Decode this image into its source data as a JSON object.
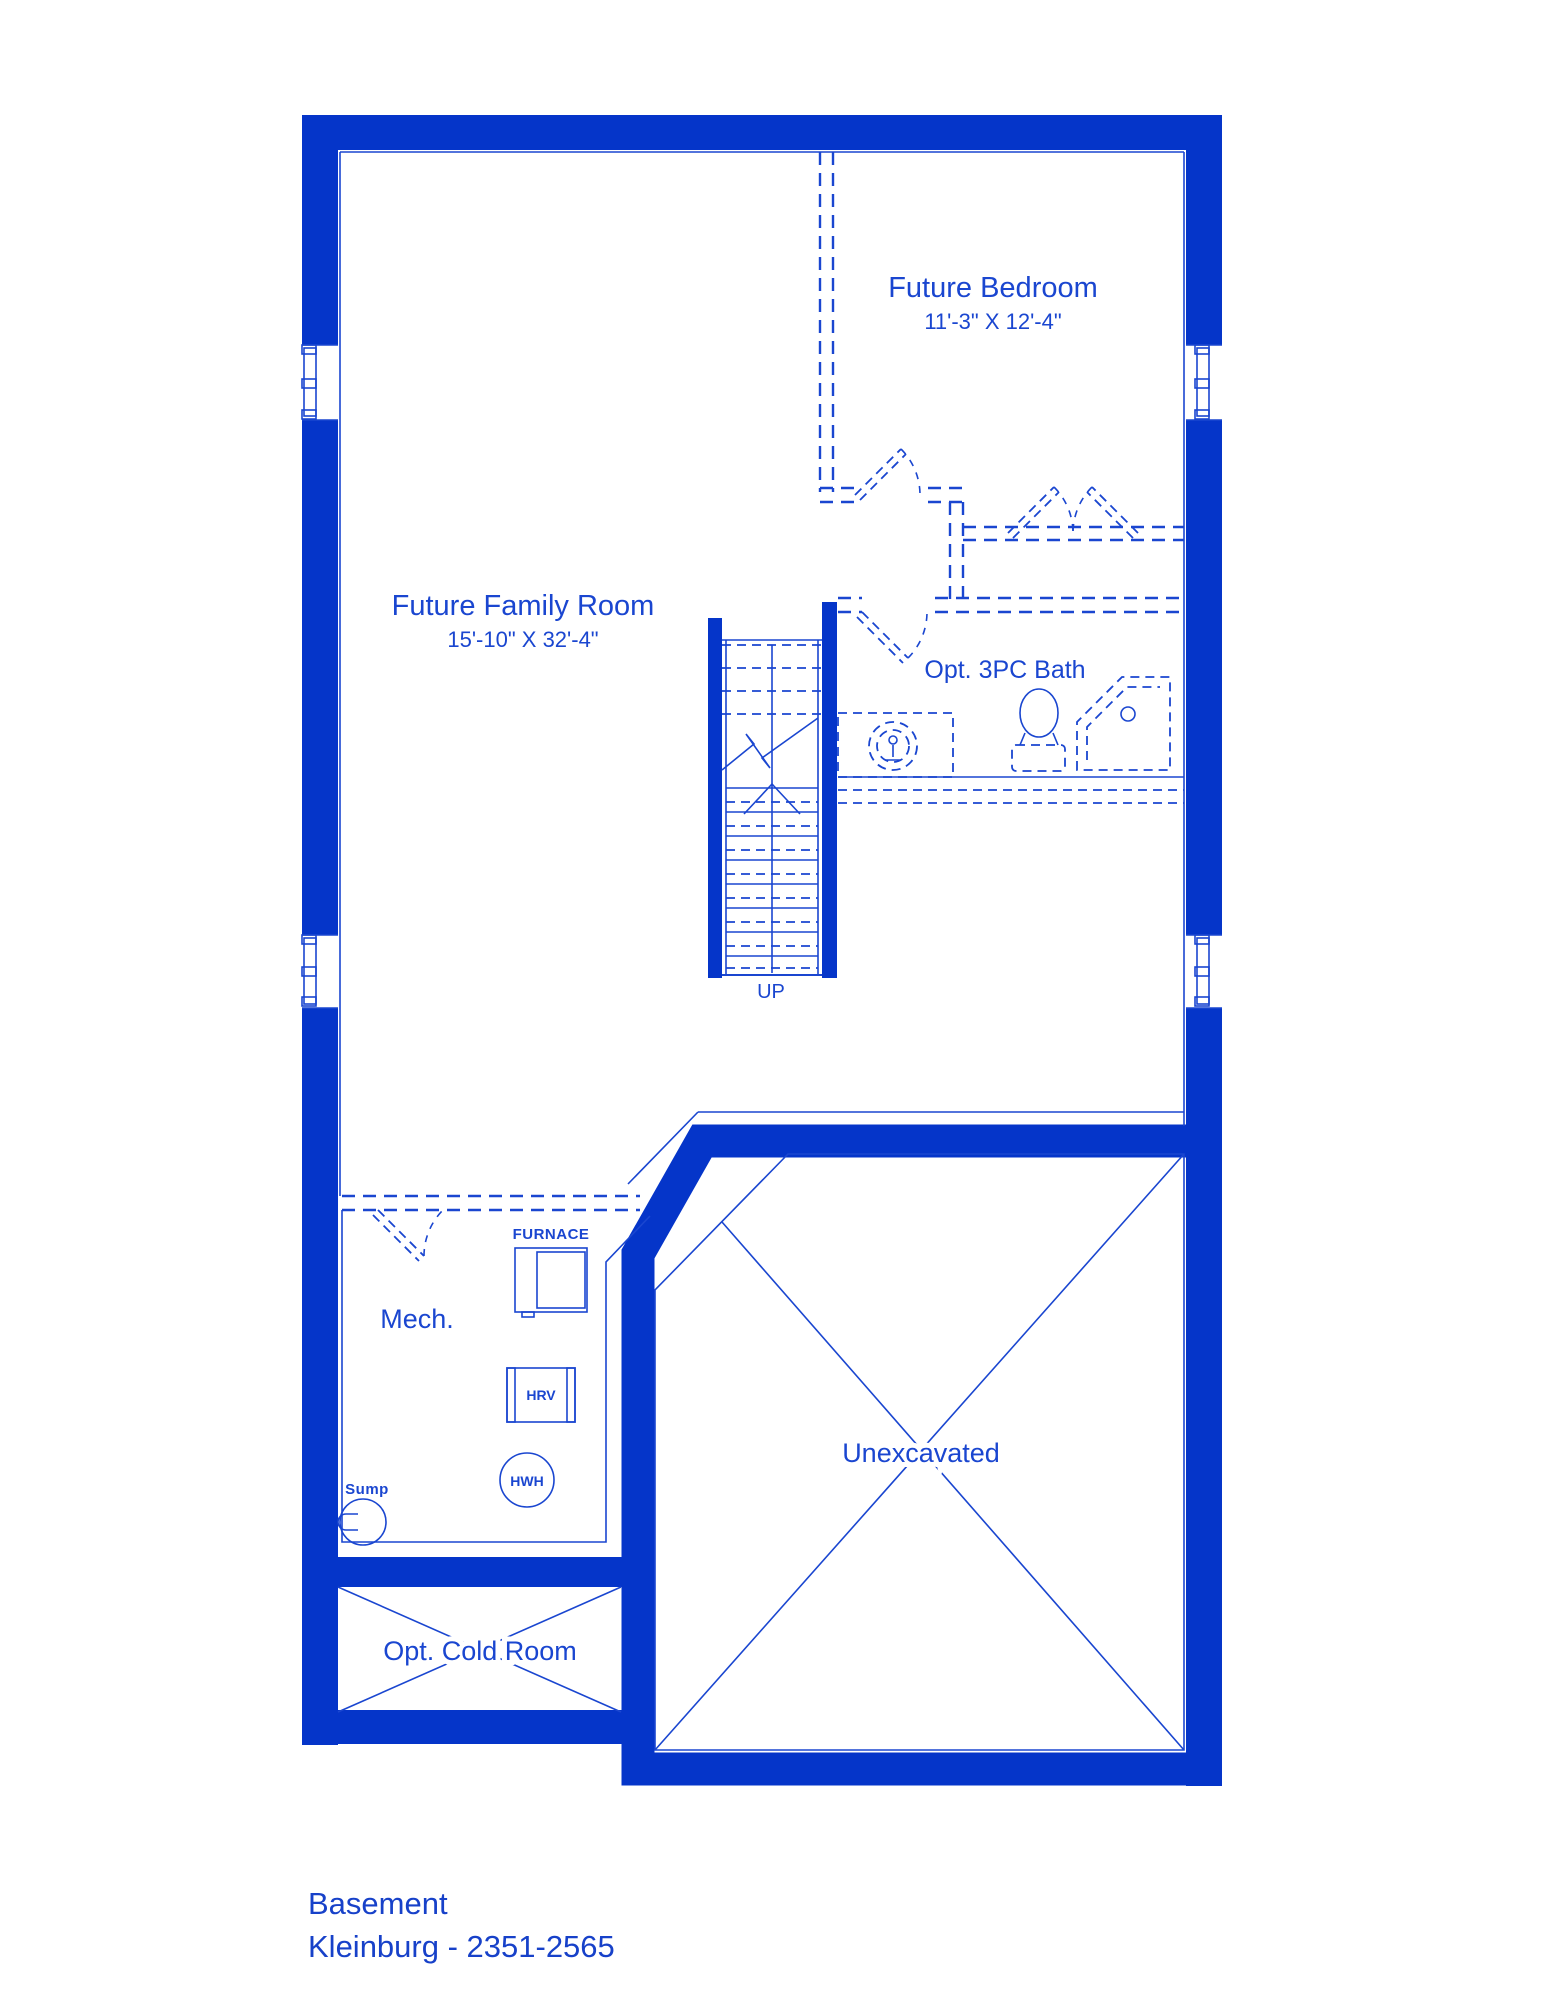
{
  "plan": {
    "rooms": {
      "future_bedroom": {
        "label": "Future Bedroom",
        "dimensions": "11'-3\" X 12'-4\""
      },
      "future_family_room": {
        "label": "Future Family Room",
        "dimensions": "15'-10\" X 32'-4\""
      },
      "opt_bath": {
        "label": "Opt. 3PC Bath"
      },
      "mech": {
        "label": "Mech."
      },
      "unexcavated": {
        "label": "Unexcavated"
      },
      "cold_room": {
        "label": "Opt. Cold Room"
      }
    },
    "stairs": {
      "direction_label": "UP"
    },
    "equipment": {
      "furnace": {
        "label": "FURNACE"
      },
      "hrv": {
        "label": "HRV"
      },
      "hwh": {
        "label": "HWH"
      },
      "sump": {
        "label": "Sump"
      }
    },
    "title": {
      "floor": "Basement",
      "model": "Kleinburg - 2351-2565"
    },
    "colors": {
      "wall": "#0535c9",
      "line": "#1a46d0",
      "text": "#1a46d0",
      "title": "#1741c9"
    }
  }
}
